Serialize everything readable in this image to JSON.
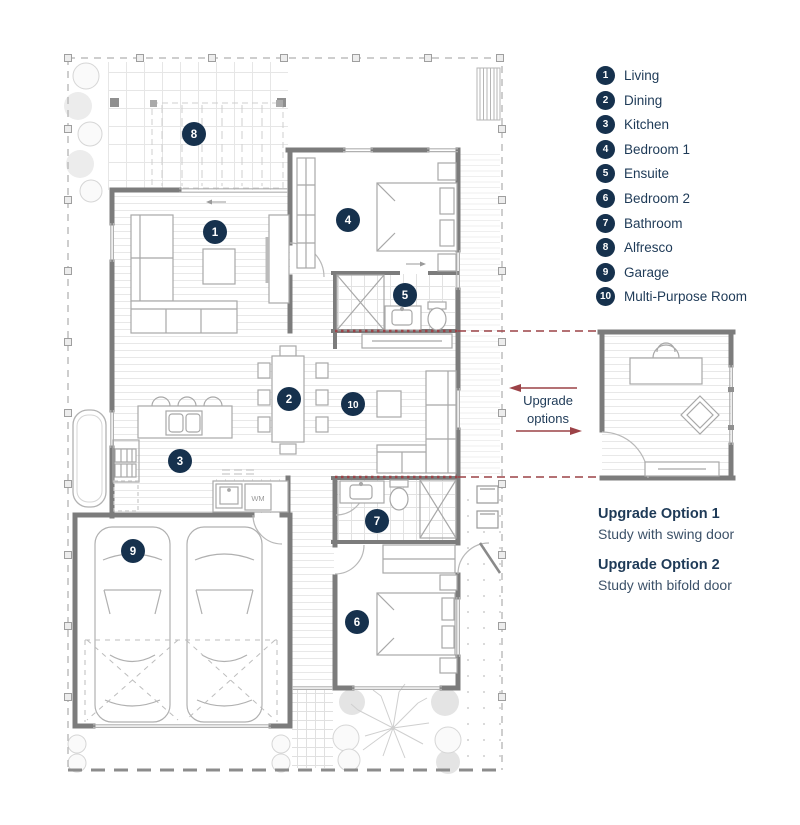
{
  "legend": {
    "items": [
      {
        "num": "1",
        "label": "Living"
      },
      {
        "num": "2",
        "label": "Dining"
      },
      {
        "num": "3",
        "label": "Kitchen"
      },
      {
        "num": "4",
        "label": "Bedroom 1"
      },
      {
        "num": "5",
        "label": "Ensuite"
      },
      {
        "num": "6",
        "label": "Bedroom 2"
      },
      {
        "num": "7",
        "label": "Bathroom"
      },
      {
        "num": "8",
        "label": "Alfresco"
      },
      {
        "num": "9",
        "label": "Garage"
      },
      {
        "num": "10",
        "label": "Multi-Purpose Room"
      }
    ]
  },
  "plan_markers": [
    {
      "num": "1",
      "x": 215,
      "y": 232
    },
    {
      "num": "2",
      "x": 289,
      "y": 399
    },
    {
      "num": "3",
      "x": 180,
      "y": 461
    },
    {
      "num": "4",
      "x": 348,
      "y": 220
    },
    {
      "num": "5",
      "x": 405,
      "y": 295
    },
    {
      "num": "6",
      "x": 357,
      "y": 622
    },
    {
      "num": "7",
      "x": 377,
      "y": 521
    },
    {
      "num": "8",
      "x": 194,
      "y": 134
    },
    {
      "num": "9",
      "x": 133,
      "y": 551
    },
    {
      "num": "10",
      "x": 353,
      "y": 404
    }
  ],
  "labels": {
    "wm": "WM",
    "upgrade_arrow_line1": "Upgrade",
    "upgrade_arrow_line2": "options"
  },
  "upgrade_options": [
    {
      "title": "Upgrade Option 1",
      "desc": "Study with swing door"
    },
    {
      "title": "Upgrade Option 2",
      "desc": "Study with bifold door"
    }
  ],
  "colors": {
    "navy": "#16314d",
    "maroon": "#9c4247",
    "wall": "#7c7c7c"
  }
}
